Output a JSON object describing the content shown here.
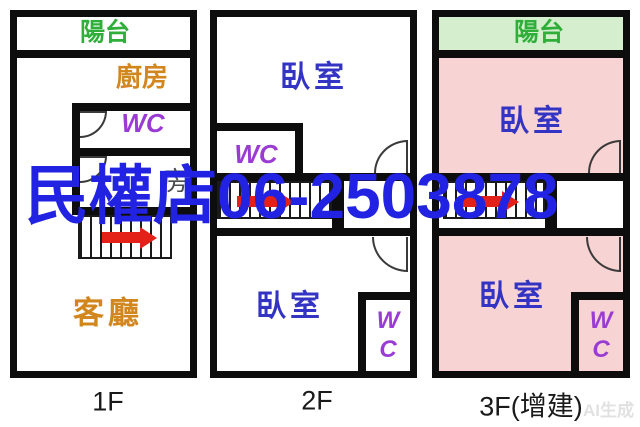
{
  "watermark": {
    "text": "民權店06-2503878",
    "color": "#2222e2"
  },
  "corner_watermark": {
    "text": "AI生成"
  },
  "colors": {
    "wall": "#0d0d0d",
    "balcony_text_green": "#2fae3a",
    "balcony_fill_green": "#d5eecd",
    "room_fill_pink": "#f8d3d3",
    "bedroom_text_blue": "#3434c4",
    "kitchen_living_text_orange": "#d2861e",
    "wc_text_purple": "#9a3cd4",
    "stair_arrow_red": "#e32119",
    "caption_text": "#1a1a1a"
  },
  "floors": [
    {
      "caption": "1F",
      "rooms": {
        "balcony": "陽台",
        "kitchen": "廚房",
        "wc": "WC",
        "side_room": "房",
        "living": "客廳"
      }
    },
    {
      "caption": "2F",
      "rooms": {
        "bedroom_top": "臥室",
        "wc": "WC",
        "bedroom_bottom": "臥室",
        "wc2_line1": "W",
        "wc2_line2": "C"
      }
    },
    {
      "caption": "3F(增建)",
      "rooms": {
        "balcony": "陽台",
        "bedroom_top": "臥室",
        "bedroom_bottom": "臥室",
        "wc_line1": "W",
        "wc_line2": "C"
      }
    }
  ]
}
